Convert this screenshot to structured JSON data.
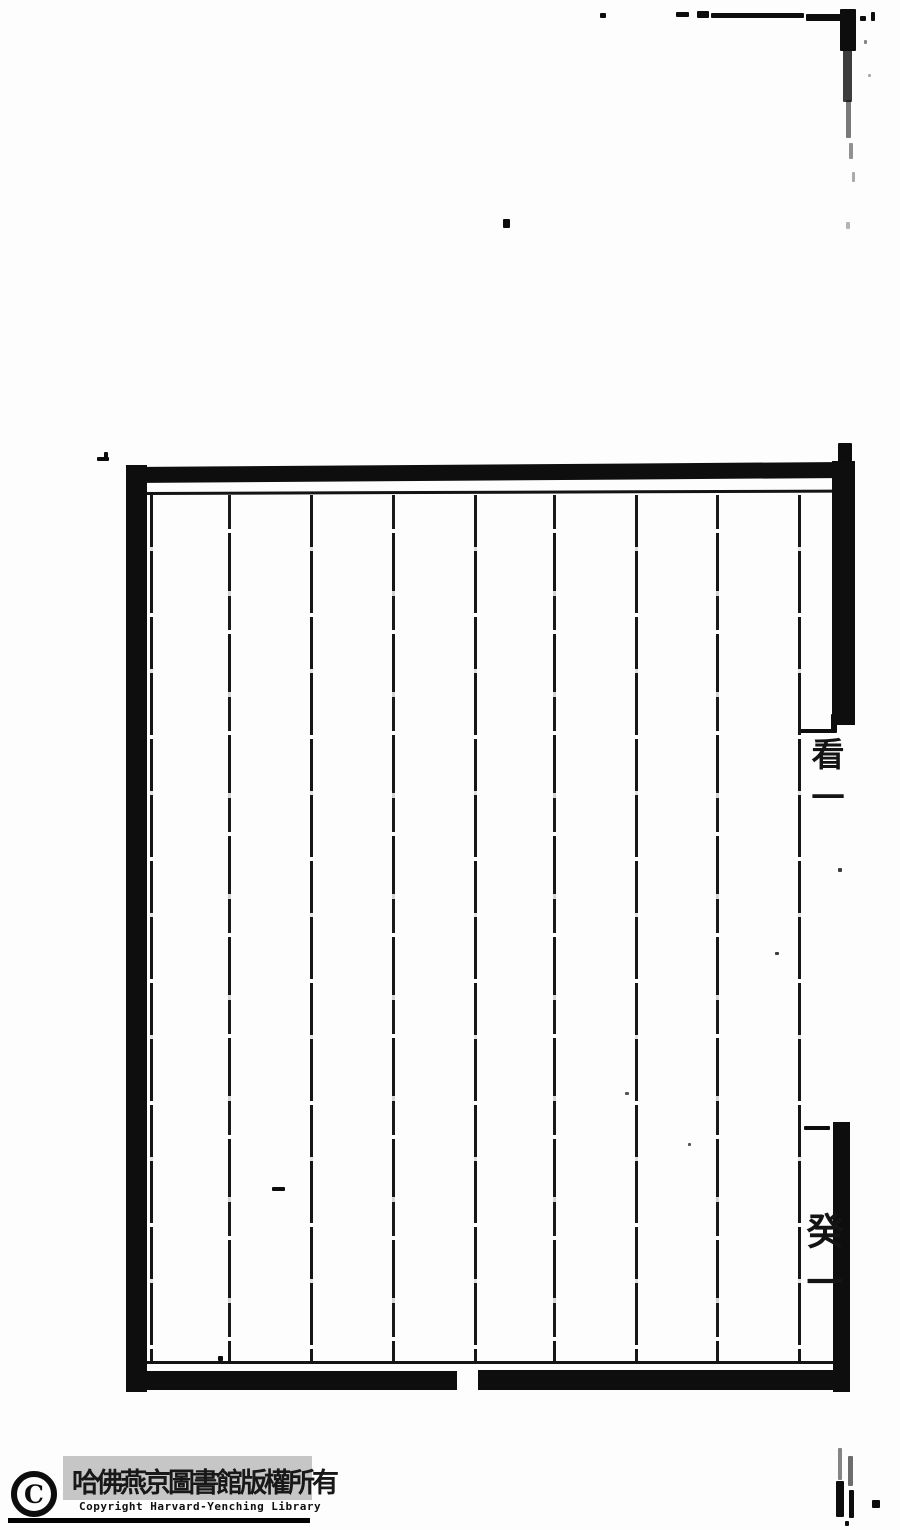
{
  "colors": {
    "ink": "#111111",
    "paper": "#fdfdfd",
    "stamp_gray_box": "#c6c6c6"
  },
  "stamp": {
    "symbol": "C",
    "chinese_text": "哈佛燕京圖書館版權所有",
    "english_text": "Copyright Harvard-Yenching Library"
  },
  "margin_labels": {
    "upper": "看一",
    "lower": "癸一"
  },
  "frame": {
    "columns": 8,
    "column_lines_x": [
      150,
      228,
      310,
      392,
      474,
      553,
      635,
      716,
      798
    ],
    "line_top": 495,
    "line_bottom": 1361
  },
  "artifacts": [
    {
      "x": 600,
      "y": 13,
      "w": 6,
      "h": 5
    },
    {
      "x": 676,
      "y": 12,
      "w": 13,
      "h": 5
    },
    {
      "x": 697,
      "y": 11,
      "w": 12,
      "h": 7
    },
    {
      "x": 711,
      "y": 13,
      "w": 93,
      "h": 5
    },
    {
      "x": 806,
      "y": 14,
      "w": 40,
      "h": 7
    },
    {
      "x": 840,
      "y": 9,
      "w": 16,
      "h": 42
    },
    {
      "x": 843,
      "y": 50,
      "w": 9,
      "h": 52,
      "o": 0.8
    },
    {
      "x": 846,
      "y": 100,
      "w": 5,
      "h": 38,
      "o": 0.55
    },
    {
      "x": 849,
      "y": 143,
      "w": 4,
      "h": 16,
      "o": 0.45
    },
    {
      "x": 852,
      "y": 172,
      "w": 3,
      "h": 10,
      "o": 0.35
    },
    {
      "x": 846,
      "y": 222,
      "w": 4,
      "h": 7,
      "o": 0.3
    },
    {
      "x": 860,
      "y": 16,
      "w": 6,
      "h": 5
    },
    {
      "x": 871,
      "y": 12,
      "w": 4,
      "h": 9
    },
    {
      "x": 864,
      "y": 40,
      "w": 3,
      "h": 4,
      "o": 0.5
    },
    {
      "x": 868,
      "y": 74,
      "w": 3,
      "h": 3,
      "o": 0.35
    },
    {
      "x": 838,
      "y": 443,
      "w": 14,
      "h": 20
    },
    {
      "x": 503,
      "y": 219,
      "w": 7,
      "h": 9
    },
    {
      "x": 97,
      "y": 457,
      "w": 12,
      "h": 4
    },
    {
      "x": 104,
      "y": 452,
      "w": 4,
      "h": 6
    },
    {
      "x": 272,
      "y": 1187,
      "w": 13,
      "h": 4
    },
    {
      "x": 218,
      "y": 1356,
      "w": 5,
      "h": 5
    },
    {
      "x": 775,
      "y": 952,
      "w": 4,
      "h": 3,
      "o": 0.8
    },
    {
      "x": 838,
      "y": 868,
      "w": 4,
      "h": 4,
      "o": 0.8
    },
    {
      "x": 688,
      "y": 1143,
      "w": 3,
      "h": 3,
      "o": 0.7
    },
    {
      "x": 625,
      "y": 1092,
      "w": 4,
      "h": 3,
      "o": 0.7
    },
    {
      "x": 800,
      "y": 729,
      "w": 37,
      "h": 4
    },
    {
      "x": 831,
      "y": 714,
      "w": 6,
      "h": 17
    },
    {
      "x": 804,
      "y": 1126,
      "w": 26,
      "h": 4
    },
    {
      "x": 838,
      "y": 1448,
      "w": 4,
      "h": 32,
      "o": 0.5
    },
    {
      "x": 836,
      "y": 1481,
      "w": 8,
      "h": 36
    },
    {
      "x": 848,
      "y": 1456,
      "w": 5,
      "h": 30,
      "o": 0.6
    },
    {
      "x": 849,
      "y": 1490,
      "w": 5,
      "h": 28
    },
    {
      "x": 872,
      "y": 1500,
      "w": 8,
      "h": 8
    },
    {
      "x": 845,
      "y": 1521,
      "w": 4,
      "h": 5
    }
  ]
}
